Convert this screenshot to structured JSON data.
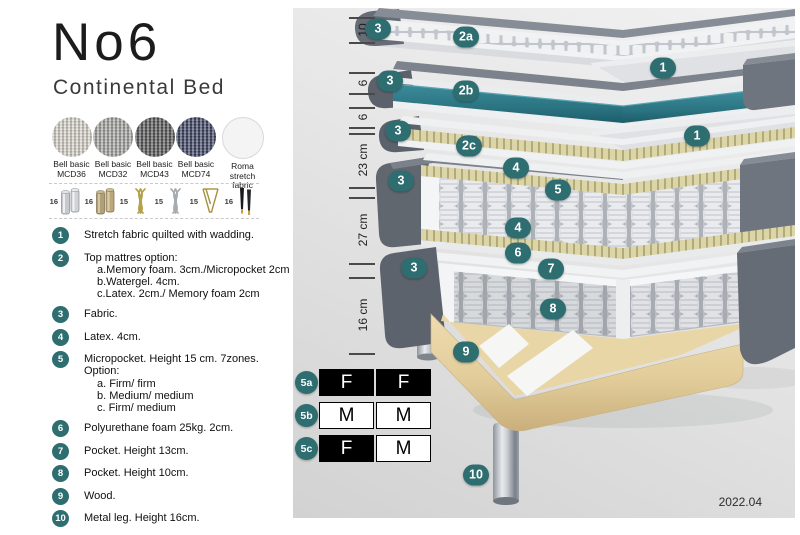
{
  "header": {
    "title": "No6",
    "subtitle": "Continental Bed"
  },
  "fabric_swatches": [
    {
      "name": "Bell basic",
      "code": "MCD36",
      "color": "#d8d4cb",
      "woven": true
    },
    {
      "name": "Bell basic",
      "code": "MCD32",
      "color": "#a6a6a4",
      "woven": true
    },
    {
      "name": "Bell basic",
      "code": "MCD43",
      "color": "#585858",
      "woven": true
    },
    {
      "name": "Bell basic",
      "code": "MCD74",
      "color": "#3e4463",
      "woven": true
    },
    {
      "name": "Roma",
      "code": "stretch fabric",
      "color": "#f4f4f4",
      "woven": false
    }
  ],
  "leg_options": [
    {
      "height": "16",
      "type": "cylinder-silver"
    },
    {
      "height": "16",
      "type": "cylinder-wood"
    },
    {
      "height": "15",
      "type": "twist-gold"
    },
    {
      "height": "15",
      "type": "twist-silver"
    },
    {
      "height": "15",
      "type": "hairpin"
    },
    {
      "height": "16",
      "type": "tapered-black"
    }
  ],
  "legend": [
    {
      "num": "1",
      "text": "Stretch fabric quilted with wadding.",
      "sub": []
    },
    {
      "num": "2",
      "text": "Top mattres option:",
      "sub": [
        "a.Memory foam. 3cm./Micropocket 2cm",
        "b.Watergel. 4cm.",
        "c.Latex. 2cm./ Memory foam 2cm"
      ]
    },
    {
      "num": "3",
      "text": "Fabric.",
      "sub": []
    },
    {
      "num": "4",
      "text": "Latex. 4cm.",
      "sub": []
    },
    {
      "num": "5",
      "text": "Micropocket. Height 15 cm. 7zones. Option:",
      "sub": [
        "a. Firm/ firm",
        "b. Medium/ medium",
        "c. Firm/ medium"
      ]
    },
    {
      "num": "6",
      "text": "Polyurethane foam 25kg. 2cm.",
      "sub": []
    },
    {
      "num": "7",
      "text": "Pocket. Height 13cm.",
      "sub": []
    },
    {
      "num": "8",
      "text": "Pocket. Height 10cm.",
      "sub": []
    },
    {
      "num": "9",
      "text": "Wood.",
      "sub": []
    },
    {
      "num": "10",
      "text": "Metal leg. Height 16cm.",
      "sub": []
    }
  ],
  "diagram": {
    "dimensions": [
      {
        "label": "10",
        "top": 9,
        "bottom": 34
      },
      {
        "label": "6",
        "top": 64,
        "bottom": 85
      },
      {
        "label": "6",
        "top": 99,
        "bottom": 119
      },
      {
        "label": "23 cm",
        "top": 125,
        "bottom": 179
      },
      {
        "label": "27 cm",
        "top": 189,
        "bottom": 255
      },
      {
        "label": "16 cm",
        "top": 269,
        "bottom": 345
      }
    ],
    "callouts": [
      {
        "label": "3",
        "x": 85,
        "y": 21
      },
      {
        "label": "2a",
        "x": 173,
        "y": 29
      },
      {
        "label": "1",
        "x": 370,
        "y": 60
      },
      {
        "label": "3",
        "x": 97,
        "y": 73
      },
      {
        "label": "2b",
        "x": 173,
        "y": 83
      },
      {
        "label": "1",
        "x": 404,
        "y": 128
      },
      {
        "label": "3",
        "x": 105,
        "y": 123
      },
      {
        "label": "2c",
        "x": 176,
        "y": 138
      },
      {
        "label": "4",
        "x": 223,
        "y": 160
      },
      {
        "label": "5",
        "x": 265,
        "y": 182
      },
      {
        "label": "3",
        "x": 108,
        "y": 173
      },
      {
        "label": "4",
        "x": 225,
        "y": 220
      },
      {
        "label": "6",
        "x": 225,
        "y": 245
      },
      {
        "label": "7",
        "x": 258,
        "y": 261
      },
      {
        "label": "3",
        "x": 121,
        "y": 260
      },
      {
        "label": "8",
        "x": 260,
        "y": 301
      },
      {
        "label": "9",
        "x": 173,
        "y": 344
      },
      {
        "label": "10",
        "x": 183,
        "y": 467
      }
    ],
    "firmness_options": [
      {
        "id": "5a",
        "cells": [
          {
            "letter": "F",
            "filled": true
          },
          {
            "letter": "F",
            "filled": true
          }
        ]
      },
      {
        "id": "5b",
        "cells": [
          {
            "letter": "M",
            "filled": false
          },
          {
            "letter": "M",
            "filled": false
          }
        ]
      },
      {
        "id": "5c",
        "cells": [
          {
            "letter": "F",
            "filled": true
          },
          {
            "letter": "M",
            "filled": false
          }
        ]
      }
    ],
    "version": "2022.04"
  },
  "colors": {
    "accent_teal": "#2e6d70",
    "watergel": "#2e7a88",
    "cover_gray": "#6e747d",
    "latex_khaki": "#d9d2a4",
    "wood": "#e8d6a6"
  }
}
